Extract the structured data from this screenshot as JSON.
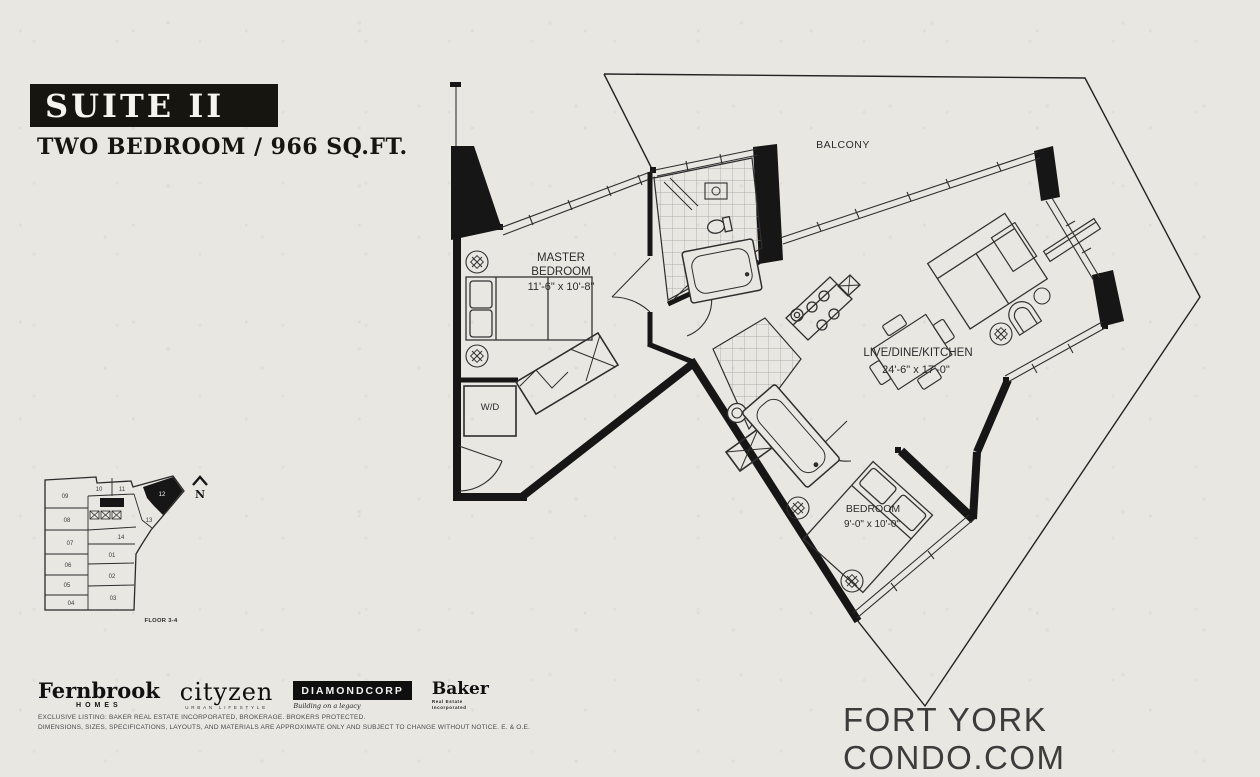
{
  "colors": {
    "paper": "#e9e7e2",
    "ink": "#1a1a1a",
    "wall": "#161616",
    "legal_gray": "#4a4a4a",
    "watermark_gray": "#3c3c3c"
  },
  "header": {
    "title": "SUITE II",
    "subtitle": "TWO BEDROOM / 966 SQ.FT."
  },
  "plan": {
    "balcony_label": "BALCONY",
    "master": {
      "line1": "MASTER",
      "line2": "BEDROOM",
      "dims": "11'-6\" x 10'-8\""
    },
    "living": {
      "line1": "LIVE/DINE/KITCHEN",
      "dims": "24'-6\" x 17'-0\""
    },
    "bedroom": {
      "line1": "BEDROOM",
      "dims": "9'-0\" x 10'-0\""
    },
    "laundry": {
      "label": "W/D"
    }
  },
  "keyplan": {
    "floor_label": "FLOOR 3-4",
    "north_label": "N",
    "highlighted_unit": "12",
    "units": [
      "01",
      "02",
      "03",
      "04",
      "05",
      "06",
      "07",
      "08",
      "09",
      "10",
      "11",
      "12",
      "13",
      "14"
    ]
  },
  "footer": {
    "logos": {
      "fernbrook": {
        "name": "Fernbrook",
        "sub": "HOMES"
      },
      "cityzen": {
        "name": "cityzen",
        "sub": "URBAN LIFESTYLE"
      },
      "diamondcorp": {
        "name": "DIAMONDCORP",
        "sub": "Building on a legacy"
      },
      "baker": {
        "name": "Baker",
        "sub1": "Real Estate",
        "sub2": "Incorporated"
      }
    },
    "legal_line1": "EXCLUSIVE LISTING: BAKER REAL ESTATE INCORPORATED, BROKERAGE. BROKERS PROTECTED.",
    "legal_line2": "DIMENSIONS, SIZES, SPECIFICATIONS, LAYOUTS, AND MATERIALS ARE APPROXIMATE ONLY AND SUBJECT TO CHANGE WITHOUT NOTICE. E. & O.E.",
    "watermark": "FORT YORK CONDO.COM"
  }
}
